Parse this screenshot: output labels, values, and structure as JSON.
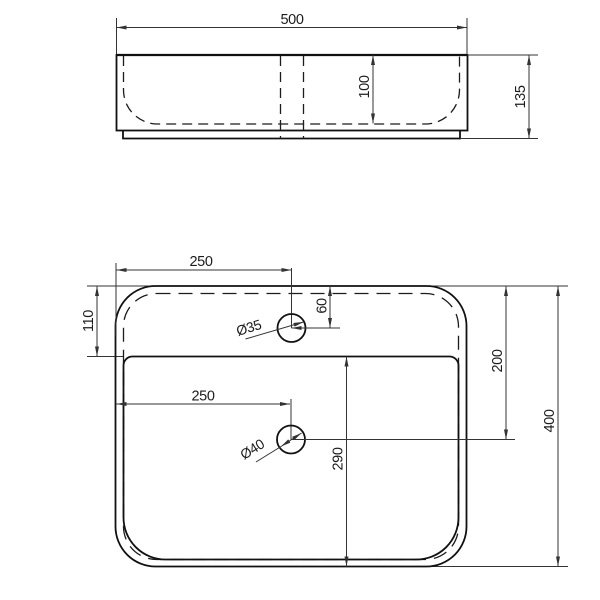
{
  "drawing": {
    "front_view": {
      "overall_width": "500",
      "bowl_depth": "100",
      "overall_height": "135"
    },
    "plan_view": {
      "faucet_from_left": "250",
      "faucet_from_back": "60",
      "back_rim_to_bowl": "110",
      "faucet_hole_dia": "Ø35",
      "drain_from_left": "250",
      "back_to_drain_center": "200",
      "bowl_top_to_front": "290",
      "drain_hole_dia": "Ø40",
      "overall_depth": "400"
    },
    "colors": {
      "object_line": "#111111",
      "dimension_line": "#333333",
      "background": "#ffffff"
    }
  }
}
